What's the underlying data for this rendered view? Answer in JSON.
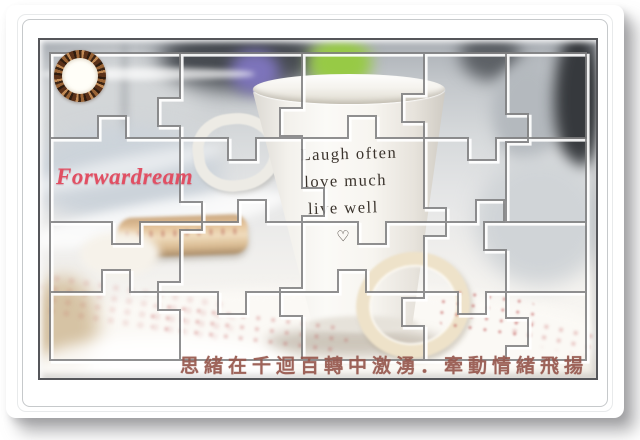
{
  "watermark": {
    "text": "Forwardream",
    "color": "#e14f63"
  },
  "logo": {
    "icon": "bead-ring-stamp-icon"
  },
  "mug": {
    "line1": "Laugh often",
    "line2": "love much",
    "line3": "live well",
    "heart_glyph": "♡",
    "ink_color": "#3a332c"
  },
  "caption": {
    "text": "思緒在千迴百轉中激湧．牽動情緒飛揚",
    "color": "#96574d"
  },
  "colors": {
    "ribbon_cream": "#eee2c9",
    "blur_green": "#97ca45",
    "blur_purple": "#7d74bb",
    "photo_border": "#55565a"
  }
}
